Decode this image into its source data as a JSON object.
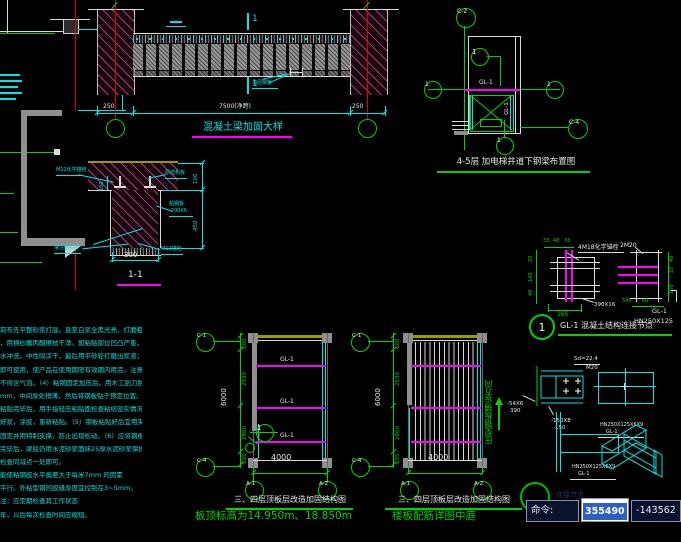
{
  "left_section": {
    "dim_vertical": "1100"
  },
  "beam_detail": {
    "title": "混凝土梁加固大样",
    "section_label_top": "1",
    "section_label_bottom": "1",
    "plate_label": "加固钢板",
    "dim_left": "250",
    "dim_span": "7500(净跨)",
    "dim_right": "250"
  },
  "elevator_plan": {
    "title": "4-5层 加电梯井道下钢梁布置图",
    "bubble_top": "C-2",
    "bubble_left": "1",
    "bubble_right": "1",
    "bubble_corner": "C-4",
    "bubble_bottom": "1",
    "detail_marker": "1",
    "beam_label": "GL-1",
    "beam_label_vertical": "GL-1"
  },
  "section_detail": {
    "title": "1-1",
    "dim_width": "300",
    "dim_slab": "100",
    "dim_depth": "450",
    "dim_anchor": "100",
    "label_anchor_left": "M12化学锚栓",
    "label_slab": "原结构板",
    "label_plate": "粘钢板",
    "label_plate2": "-200X6",
    "label_glue": "灌注结构胶",
    "label_anchor_bottom": "M12锚栓"
  },
  "notes": {
    "lines": [
      "前布先平整砂浆打底，直至白浆全黑光亮，打磨粗糙后再",
      "，用棉纱蘸丙酮擦拭干净。如粘贴部位凹凸严重，现场应",
      "水冲洗，中性晾凉干，最后用平砂轮打磨出浆液；（3）粘结",
      "即可使用，使产品在使用期限有效期内用完。注意搅拌不",
      "不得含气泡。（4）粘钢固定加压后，用木工刮刀刮抹胶层",
      "mm，中间厚处稍薄，然后将钢板贴于预定位置。粘贴完",
      "粘贴完毕后，用手指轻压粘贴面检查粘结密实情况，如有",
      "好浆，涂胶，重新粘贴。（5）钢板粘贴好后宜用夹具夹紧",
      "固定并用特制支撑，防止出现松动。（6）应将钢板粘结面",
      "完毕后，梁底仍用水泥砂浆面抹25厚水泥砂浆保护。加固",
      "检查同减点一处即可。",
      "能使粘钢胶水平偏差大于每米7mm 的因素",
      "平行。外粘型钢的胶缝厚度宜控制在3~5mm。",
      "注：应定期检查其工作状态",
      "年，以后每次检查时间应缩短。"
    ]
  },
  "plans": {
    "left": {
      "title": "三、四层顶板层改造加固结构图",
      "subtitle": "板顶标高为14.950m、18.850m",
      "bubble_tl": "C-1",
      "bubble_bl": "C-4",
      "bubble_b1": "A-1",
      "bubble_b2": "A-2",
      "dim_total": "6000",
      "dim_segs": [
        "600",
        "2530",
        "2800",
        "605"
      ],
      "dim_bottom": "4000",
      "beam1": "GL-1",
      "beam2": "GL-1",
      "beam3": "GL-1",
      "marker": "1"
    },
    "right": {
      "title": "三、四层顶板层改造加固结构图",
      "subtitle": "楼板配筋详图中庭",
      "bubble_tl": "C-1",
      "bubble_bl": "C-4",
      "bubble_b1": "A-1",
      "bubble_b2": "A-2",
      "dim_total": "6000",
      "dim_segs": [
        "600",
        "2530",
        "2800",
        "605"
      ],
      "dim_bottom": "4000",
      "deck_note": "压型钢板铺设方向"
    }
  },
  "connection_detail": {
    "number": "1",
    "title": "GL-1 混凝土结构连接节点",
    "label_anchor": "4M18化学锚栓",
    "label_bolt": "2M20",
    "label_plate": "-390X16",
    "label_beam": "GL-1",
    "label_section": "HN250X125",
    "dims_top": [
      "33",
      "48",
      "33"
    ],
    "dims_left": [
      "20",
      "140",
      "40"
    ],
    "dim_bottom": "165",
    "dims_right": [
      "40",
      "25"
    ],
    "dim_right2": "150",
    "dims_br": [
      "545",
      "60"
    ]
  },
  "steel_details": {
    "label_sd": "Sd=22.4",
    "label_bolt": "M20",
    "plate_a": "-54X6",
    "plate_a2": "390",
    "plate_b": "-150X8",
    "plate_b2": "150",
    "beam_top": "HN250X125X6X9",
    "beam_top2": "GL-1",
    "beam_bottom": "HN250X125X6X9",
    "beam_bottom2": "GL-1"
  },
  "command_bar": {
    "ghost_title": "连接节点",
    "label": "命令:",
    "coord_x": "355490",
    "coord_y": "-143562"
  }
}
